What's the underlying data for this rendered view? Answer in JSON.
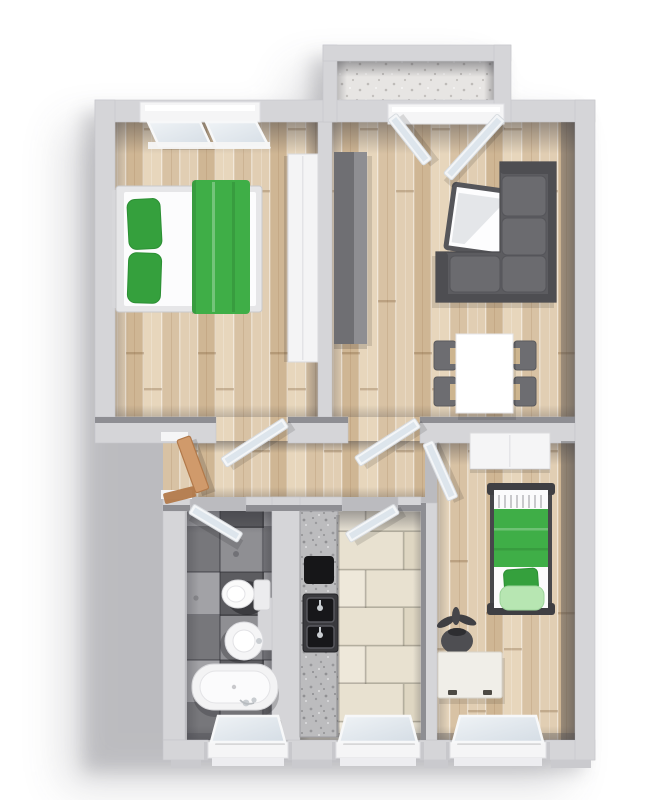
{
  "canvas": {
    "width": 667,
    "height": 800
  },
  "scene": {
    "type": "floor-plan-3d-top-view",
    "rooms": [
      {
        "id": "bedroom-main",
        "floor": "wood",
        "furniture": [
          "double-bed-green",
          "wardrobe-white",
          "tilt-window"
        ]
      },
      {
        "id": "living-room",
        "floor": "wood",
        "furniture": [
          "corner-sofa-gray",
          "tv-table",
          "media-cabinet",
          "dining-table",
          "four-chairs",
          "balcony-french-doors"
        ]
      },
      {
        "id": "balcony",
        "floor": "concrete",
        "furniture": []
      },
      {
        "id": "hallway",
        "floor": "wood",
        "furniture": [
          "entry-door-wood"
        ]
      },
      {
        "id": "bathroom",
        "floor": "dark-tile",
        "furniture": [
          "bathtub",
          "round-sink",
          "toilet",
          "tilt-window"
        ]
      },
      {
        "id": "kitchen",
        "floor": "beige-tile",
        "furniture": [
          "granite-counter",
          "cooktop",
          "double-sink",
          "tilt-window"
        ]
      },
      {
        "id": "bedroom-small",
        "floor": "wood",
        "furniture": [
          "single-bed-green",
          "wardrobe-white",
          "dresser-white",
          "plant",
          "tilt-window"
        ]
      }
    ],
    "door_count": 7,
    "window_count": 5
  },
  "colors": {
    "wall": "#d5d5d8",
    "wall_inner": "#8e8e93",
    "white_surface": "#f5f5f6",
    "glass": "#dde5ec",
    "wood_a": "#e7d6bc",
    "wood_b": "#d8c2a4",
    "wood_c": "#e1ceb3",
    "wood_d": "#cfb694",
    "tile_dark_a": "#77777b",
    "tile_dark_b": "#8f8f93",
    "tile_dark_c": "#5c5c60",
    "tile_dark_d": "#a2a2a6",
    "tile_beige_a": "#e8e1d0",
    "tile_beige_b": "#ded6c2",
    "tile_beige_c": "#eee8da",
    "balcony_floor": "#e7e5e3",
    "granite": "#bcbcbe",
    "accent_green": "#3fae47",
    "green_dark": "#35a03d",
    "green_light": "#b7e6b2",
    "sofa": "#5c5c60",
    "sofa_dark": "#4e4e52",
    "sofa_cushion": "#6b6b6f",
    "cabinet_dark": "#6f6f73",
    "cabinet_light": "#8e8e92",
    "chair": "#6d6d71",
    "door_wood": "#d09a6b",
    "door_wood_dark": "#b2794a",
    "appliance_black": "#161618",
    "steel": "#c9cdd1"
  }
}
